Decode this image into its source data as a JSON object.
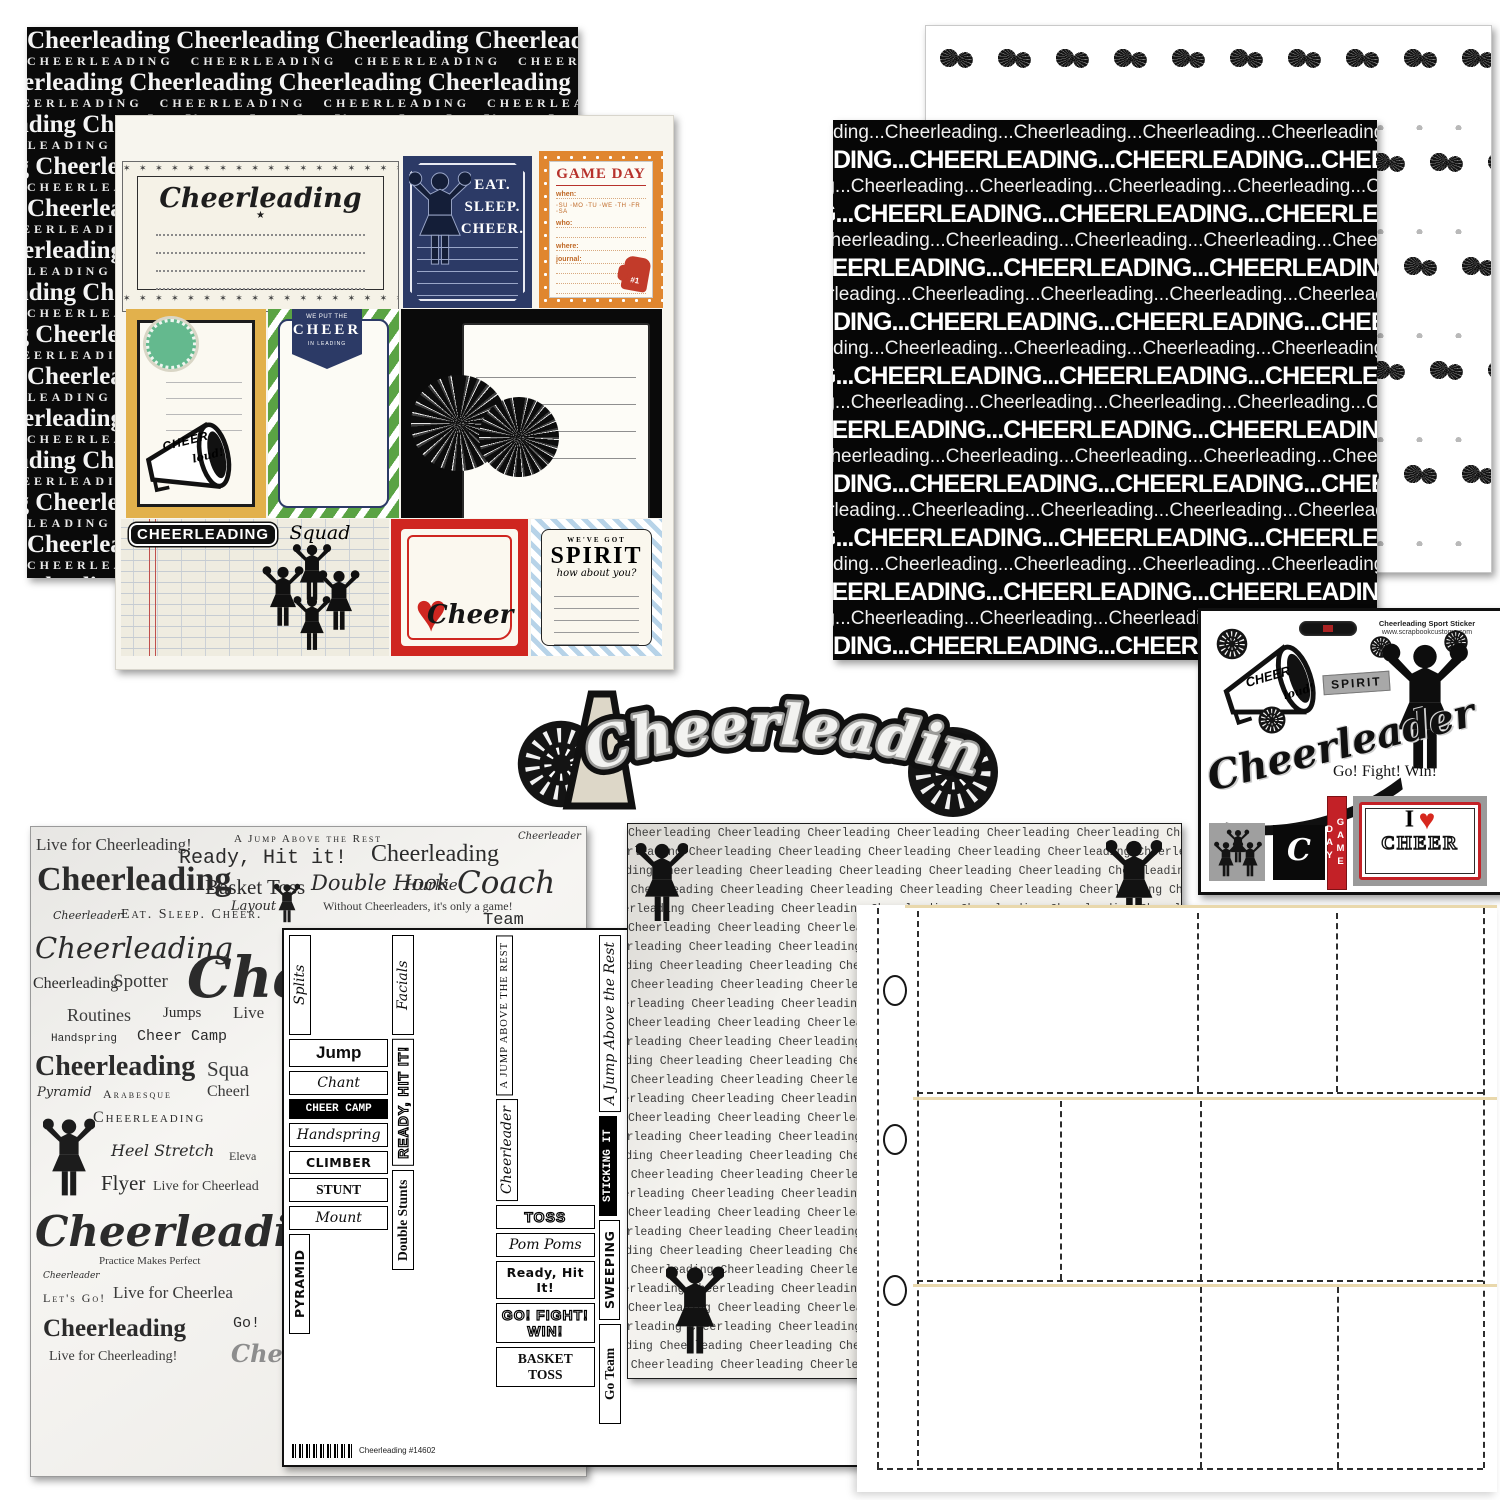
{
  "colors": {
    "navy": "#2c3a66",
    "orange": "#e0862f",
    "red": "#cf2620",
    "gold": "#e2b14c",
    "green": "#5aa344",
    "mint": "#64b98e",
    "chevron_blue": "#b7d3e8",
    "black": "#0a0a0a",
    "cream": "#f5f2e7",
    "tan_line": "#e9d8ac",
    "gray": "#9f9f9f"
  },
  "papers": {
    "top_left_bg": {
      "serif_row": "Cheerleading Cheerleading Cheerleading Cheerleading Cheerleading Cheerleading Cheerleading",
      "caps_row": "CHEERLEADING CHEERLEADING CHEERLEADING CHEERLEADING CHEERLEADING CHEERLEADING CHEERLEADING",
      "pairs": 14
    },
    "journal_cards": {
      "title_card": {
        "title": "Cheerleading",
        "star": "★",
        "ornament": "✶ ✶ ✶ ✶ ✶ ✶ ✶ ✶ ✶ ✶ ✶ ✶ ✶ ✶ ✶ ✶ ✶ ✶"
      },
      "eat_sleep_cheer": {
        "l1": "EAT.",
        "l2": "SLEEP.",
        "l3": "CHEER."
      },
      "game_day": {
        "title": "GAME DAY",
        "when": "when:",
        "days": "◦SU ◦MO ◦TU ◦WE ◦TH ◦FR ◦SA",
        "who": "who:",
        "where": "where:",
        "journal": "journal:",
        "fan": "#1"
      },
      "cheer_loud": {
        "l1": "CHEER",
        "l2": "loud!"
      },
      "banner": {
        "top": "WE PUT THE",
        "mid": "CHEER",
        "bottom": "IN LEADING"
      },
      "squad": {
        "main": "CHEERLEADING",
        "script": "Squad"
      },
      "cheer_heart": {
        "word": "Cheer",
        "heart": "♥"
      },
      "spirit": {
        "top": "WE'VE GOT",
        "main": "SPIRIT",
        "sub": "how about you?"
      }
    },
    "pom_dots": {
      "pom_rows": 5,
      "poms_per_row": 10
    },
    "black_rows": {
      "bold_row": "DING...CHEERLEADING...CHEERLEADING...CHEERLEADING...CHEERLEADING...CHEERLEADING...C",
      "light_row": "ding...Cheerleading...Cheerleading...Cheerleading...Cheerleading...Cheerleading...Cheerleadin",
      "pairs": 10
    },
    "typewriter": {
      "row": "Cheerleading  Cheerleading  Cheerleading  Cheerleading  Cheerleading  Cheerleading  Cheerleading  Cheerleading",
      "count": 29
    },
    "word_collage": {
      "words": [
        {
          "t": "Live for Cheerleading!",
          "x": 5,
          "y": 8,
          "s": 17,
          "c": "w-light"
        },
        {
          "t": "Ready, Hit it!",
          "x": 148,
          "y": 20,
          "s": 20,
          "c": "w-mono"
        },
        {
          "t": "A Jump Above the Rest",
          "x": 203,
          "y": 6,
          "s": 11,
          "c": "w-caps"
        },
        {
          "t": "Cheerleading",
          "x": 340,
          "y": 14,
          "s": 24,
          "c": "w-serif"
        },
        {
          "t": "Cheerleader",
          "x": 487,
          "y": 4,
          "s": 10,
          "c": "w-script"
        },
        {
          "t": "Cheerleading",
          "x": 6,
          "y": 34,
          "s": 34,
          "c": "w-serifb"
        },
        {
          "t": "Basket Toss",
          "x": 174,
          "y": 48,
          "s": 21,
          "c": "w-serif"
        },
        {
          "t": "Double Hook",
          "x": 280,
          "y": 44,
          "s": 21,
          "c": "w-script"
        },
        {
          "t": "Hurkie",
          "x": 374,
          "y": 49,
          "s": 15,
          "c": "w-script"
        },
        {
          "t": "Coach",
          "x": 426,
          "y": 38,
          "s": 31,
          "c": "w-script"
        },
        {
          "t": "Cheerleader",
          "x": 22,
          "y": 82,
          "s": 11,
          "c": "w-script"
        },
        {
          "t": "Eat. Sleep. Cheer.",
          "x": 90,
          "y": 80,
          "s": 14,
          "c": "w-caps"
        },
        {
          "t": "Layout",
          "x": 200,
          "y": 72,
          "s": 13,
          "c": "w-script"
        },
        {
          "t": "Without Cheerleaders, it's only a game!",
          "x": 292,
          "y": 72,
          "s": 12,
          "c": "w-light"
        },
        {
          "t": "Team",
          "x": 452,
          "y": 84,
          "s": 17,
          "c": "w-mono"
        },
        {
          "t": "Cheerleading",
          "x": 4,
          "y": 104,
          "s": 29,
          "c": "w-script"
        },
        {
          "t": "Cheerleading",
          "x": 2,
          "y": 148,
          "s": 16,
          "c": "w-serif"
        },
        {
          "t": "Spotter",
          "x": 82,
          "y": 144,
          "s": 19,
          "c": "w-light"
        },
        {
          "t": "Cheer",
          "x": 156,
          "y": 118,
          "s": 56,
          "c": "w-scriptb"
        },
        {
          "t": "Routines",
          "x": 36,
          "y": 178,
          "s": 18,
          "c": "w-light"
        },
        {
          "t": "Jumps",
          "x": 132,
          "y": 178,
          "s": 15,
          "c": "w-serif"
        },
        {
          "t": "Live",
          "x": 202,
          "y": 176,
          "s": 17,
          "c": "w-light"
        },
        {
          "t": "Handspring",
          "x": 20,
          "y": 206,
          "s": 11,
          "c": "w-mono"
        },
        {
          "t": "Cheer Camp",
          "x": 106,
          "y": 201,
          "s": 15,
          "c": "w-mono"
        },
        {
          "t": "Cheerleading",
          "x": 4,
          "y": 224,
          "s": 28,
          "c": "w-serifb"
        },
        {
          "t": "Squa",
          "x": 176,
          "y": 230,
          "s": 21,
          "c": "w-light"
        },
        {
          "t": "Pyramid",
          "x": 6,
          "y": 258,
          "s": 13,
          "c": "w-script"
        },
        {
          "t": "Arabesque",
          "x": 72,
          "y": 260,
          "s": 12,
          "c": "w-caps"
        },
        {
          "t": "Cheerl",
          "x": 176,
          "y": 256,
          "s": 16,
          "c": "w-light"
        },
        {
          "t": "Cheerleading",
          "x": 62,
          "y": 282,
          "s": 16,
          "c": "w-caps"
        },
        {
          "t": "Heel Stretch",
          "x": 80,
          "y": 314,
          "s": 16,
          "c": "w-script"
        },
        {
          "t": "Eleva",
          "x": 198,
          "y": 322,
          "s": 12,
          "c": "w-light"
        },
        {
          "t": "Flyer",
          "x": 70,
          "y": 344,
          "s": 21,
          "c": "w-serif"
        },
        {
          "t": "Live for Cheerlead",
          "x": 122,
          "y": 352,
          "s": 14,
          "c": "w-light"
        },
        {
          "t": "Cheerleading",
          "x": 4,
          "y": 380,
          "s": 42,
          "c": "w-scriptb"
        },
        {
          "t": "Practice Makes Perfect",
          "x": 68,
          "y": 428,
          "s": 11,
          "c": "w-light"
        },
        {
          "t": "Cheerleader",
          "x": 12,
          "y": 444,
          "s": 9,
          "c": "w-script"
        },
        {
          "t": "Let's Go!",
          "x": 12,
          "y": 464,
          "s": 12,
          "c": "w-caps"
        },
        {
          "t": "Live for Cheerlea",
          "x": 82,
          "y": 456,
          "s": 17,
          "c": "w-light"
        },
        {
          "t": "Cheerleading",
          "x": 12,
          "y": 488,
          "s": 25,
          "c": "w-serifb"
        },
        {
          "t": "Go!",
          "x": 202,
          "y": 488,
          "s": 15,
          "c": "w-mono"
        },
        {
          "t": "Live for Cheerleading!",
          "x": 18,
          "y": 522,
          "s": 14,
          "c": "w-light"
        },
        {
          "t": "Chee",
          "x": 200,
          "y": 512,
          "s": 24,
          "c": "w-scriptb w-gray"
        }
      ]
    },
    "word_blocks": {
      "items": [
        {
          "t": "Splits",
          "s": "s",
          "v": true
        },
        {
          "t": "Jump",
          "s": "b"
        },
        {
          "t": "Chant",
          "s": "s"
        },
        {
          "t": "CHEER CAMP",
          "s": "inv"
        },
        {
          "t": "Handspring",
          "s": "s"
        },
        {
          "t": "CLIMBER",
          "s": "f"
        },
        {
          "t": "STUNT",
          "s": "sb"
        },
        {
          "t": "Mount",
          "s": "s"
        },
        {
          "t": "PYRAMID",
          "s": "f",
          "v": true
        },
        {
          "t": "Facials",
          "s": "s",
          "v": true
        },
        {
          "t": "READY, HIT IT!",
          "s": "o",
          "v": true
        },
        {
          "t": "Double Stunts",
          "s": "sb",
          "v": true
        },
        {
          "t": "A JUMP ABOVE THE REST",
          "s": "c",
          "v": true
        },
        {
          "t": "Cheerleader",
          "s": "s",
          "v": true
        },
        {
          "t": "TOSS",
          "s": "o"
        },
        {
          "t": "Pom Poms",
          "s": "s"
        },
        {
          "t": "Ready, Hit It!",
          "s": "f"
        },
        {
          "t": "GO! FIGHT! WIN!",
          "s": "o"
        },
        {
          "t": "BASKET TOSS",
          "s": "sb"
        },
        {
          "t": "A Jump Above the Rest",
          "s": "s",
          "v": true
        },
        {
          "t": "STICKING IT",
          "s": "inv",
          "v": true
        },
        {
          "t": "SWEEPING",
          "s": "f",
          "v": true
        },
        {
          "t": "Go Team",
          "s": "sb",
          "v": true
        },
        {
          "t": "Splits",
          "s": "sb"
        },
        {
          "t": "LAYOUT",
          "s": "o"
        },
        {
          "t": "CHEER",
          "s": "meg"
        },
        {
          "t": "Heel Stretch",
          "s": "s"
        },
        {
          "t": "Mount",
          "s": "s"
        },
        {
          "t": "Stunt",
          "s": "b"
        },
        {
          "t": "Flyer",
          "s": "o",
          "v": true
        },
        {
          "t": "Free Liberty",
          "s": "s"
        },
        {
          "t": "ROUTINES",
          "s": "sb"
        },
        {
          "t": "HEEL STRETCH",
          "s": "f"
        },
        {
          "t": "Full Elevator",
          "s": "s",
          "v": true
        },
        {
          "t": "FLICKING",
          "s": "f",
          "v": true
        },
        {
          "t": "EAT. SLEEP. CHEER.",
          "s": "f"
        },
        {
          "t": "Sponging Up",
          "s": "s"
        },
        {
          "t": "Hooray!",
          "s": "s"
        },
        {
          "t": "Free Liberty",
          "s": "sb",
          "v": true
        },
        {
          "t": "Without Cheerleaders, It's Only a Game!",
          "s": "s",
          "v": true
        },
        {
          "t": "HANDSPRING",
          "s": "sb",
          "v": true
        },
        {
          "t": "CHEER",
          "s": "meg"
        },
        {
          "t": "ARABESQUE",
          "s": "o"
        },
        {
          "t": "CHEERLEADER",
          "s": "st"
        },
        {
          "t": "Born to Cheer",
          "s": "sb"
        },
        {
          "t": "TUMBLING VAULT",
          "s": "f"
        },
        {
          "t": "Stunt",
          "s": "f",
          "v": true
        },
        {
          "t": "Cheer",
          "s": "s",
          "v": true
        },
        {
          "t": "DOUBLE STUNTS",
          "s": "sb",
          "v": true
        },
        {
          "t": "EXTENSION",
          "s": "sb",
          "v": true
        },
        {
          "t": "Cradle Catch",
          "s": "m",
          "v": true
        },
        {
          "t": "Arabesque",
          "s": "b"
        },
        {
          "t": "CHEERLEADER",
          "s": "f",
          "v": true
        },
        {
          "t": "DISMOUNT",
          "s": "sb",
          "v": true
        },
        {
          "t": "TOSS",
          "s": "inv"
        },
        {
          "t": "Ready, Okay!",
          "s": "m"
        },
        {
          "t": "Pom Poms",
          "s": "s"
        },
        {
          "t": "Sticking It",
          "s": "s"
        },
        {
          "t": "Spotter",
          "s": "s",
          "v": true
        },
        {
          "t": "Hooray!",
          "s": "s",
          "v": true
        },
        {
          "t": "Flyer",
          "s": "sb"
        },
        {
          "t": "CLIMBER",
          "s": "o",
          "v": true
        },
        {
          "t": "Stunt",
          "s": "s"
        },
        {
          "t": "Routines",
          "s": "m"
        }
      ],
      "barcode_label": "Cheerleading #14602"
    }
  },
  "title_diecut": {
    "text": "Cheerleading"
  },
  "sticker_sheet": {
    "header_line1": "Cheerleading Sport Sticker",
    "header_line2": "www.scrapbookcustoms.com",
    "megaphone": {
      "l1": "CHEER",
      "l2": "loud!"
    },
    "spirit": "SPIRIT",
    "script_word": "Cheerleader",
    "go_fight_win": "Go! Fight! Win!",
    "game_day": "GAME DAY",
    "i_heart": {
      "i": "I",
      "heart": "♥",
      "cheer": "CHEER"
    },
    "c_glyph": "C"
  }
}
